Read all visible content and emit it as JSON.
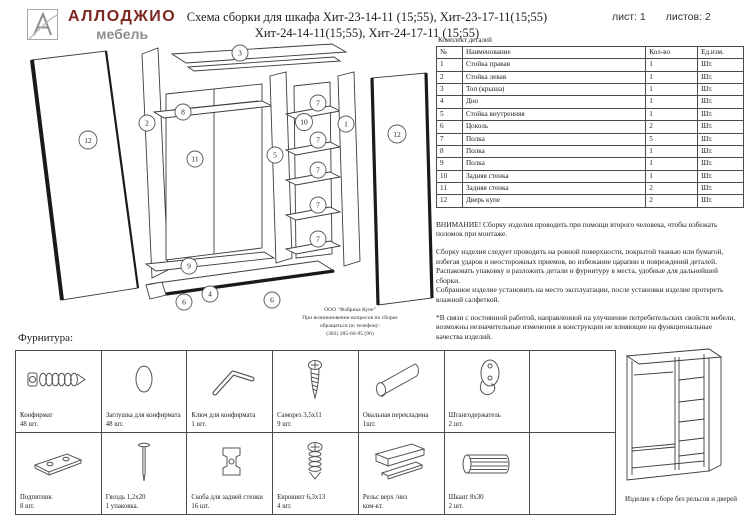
{
  "header": {
    "brand": "АЛЛОДЖИО",
    "brand_sub": "мебель",
    "brand_color": "#7d2723",
    "title_line1": "Схема сборки для шкафа Хит-23-14-11 (15;55), Хит-23-17-11(15;55)",
    "title_line2": "Хит-24-14-11(15;55), Хит-24-17-11 (15;55)",
    "sheet_label": "лист: 1",
    "sheets_label": "листов: 2"
  },
  "parts_table": {
    "caption": "Комплект деталей",
    "columns": [
      "№",
      "Наименование",
      "Кол-во",
      "Ед.изм."
    ],
    "rows": [
      {
        "n": "1",
        "name": "Стойка правая",
        "qty": "1",
        "unit": "Шт."
      },
      {
        "n": "2",
        "name": "Стойка левая",
        "qty": "1",
        "unit": "Шт."
      },
      {
        "n": "3",
        "name": "Топ (крыша)",
        "qty": "1",
        "unit": "Шт."
      },
      {
        "n": "4",
        "name": "Дно",
        "qty": "1",
        "unit": "Шт."
      },
      {
        "n": "5",
        "name": "Стойка внутренняя",
        "qty": "1",
        "unit": "Шт."
      },
      {
        "n": "6",
        "name": "Цоколь",
        "qty": "2",
        "unit": "Шт."
      },
      {
        "n": "7",
        "name": "Полка",
        "qty": "5",
        "unit": "Шт."
      },
      {
        "n": "8",
        "name": "Полка",
        "qty": "1",
        "unit": "Шт."
      },
      {
        "n": "9",
        "name": "Полка",
        "qty": "1",
        "unit": "Шт."
      },
      {
        "n": "10",
        "name": "Задняя стенка",
        "qty": "1",
        "unit": "Шт."
      },
      {
        "n": "11",
        "name": "Задняя стенка",
        "qty": "2",
        "unit": "Шт."
      },
      {
        "n": "12",
        "name": "Дверь купе",
        "qty": "2",
        "unit": "Шт."
      }
    ]
  },
  "notes": {
    "warning": "ВНИМАНИЕ! Сборку изделия проводить при помощи второго человека, чтобы избежать поломок при монтаже.",
    "p1": "Сборку изделия следует проводить на ровной поверхности, покрытой тканью или бумагой, избегая ударов и неосторожных приемов, во избежание царапин и повреждений деталей.",
    "p2": "Распаковать упаковку и разложить детали и фурнитуру в места, удобные для дальнейшей сборки.",
    "p3": "Собранное изделие установить на место эксплуатации, после установки изделие протереть влажной салфеткой.",
    "p4": "*В связи с постоянной работой, направленной на улучшение потребительских свойств мебели, возможны незначительные изменения в конструкции не влияющие на функциональные качества изделий."
  },
  "factory_note": {
    "line1": "ООО \"Фабрика Купе\"",
    "line2": "При возникновении вопросов по сборке",
    "line3": "обращаться по телефону:",
    "line4": "(383) 285-60-95 (96)"
  },
  "diagram": {
    "callouts": [
      "3",
      "12",
      "2",
      "8",
      "11",
      "5",
      "10",
      "7",
      "7",
      "7",
      "7",
      "7",
      "1",
      "12",
      "9",
      "4",
      "6",
      "6"
    ]
  },
  "hardware": {
    "heading": "Фурнитура:",
    "items": [
      {
        "name": "Конфирмат",
        "qty": "48 шт.",
        "icon": "confirmat-screw-icon"
      },
      {
        "name": "Заглушка для конфирмата",
        "qty": "48 шт.",
        "icon": "cap-icon"
      },
      {
        "name": "Ключ для конфирмата",
        "qty": "1 шт.",
        "icon": "hex-key-icon"
      },
      {
        "name": "Саморез 3,5х11",
        "qty": "9 шт.",
        "icon": "screw-icon"
      },
      {
        "name": "Овальная перекладина",
        "qty": "1шт.",
        "icon": "oval-rail-icon"
      },
      {
        "name": "Штангодержатель",
        "qty": "2 шт.",
        "icon": "rod-holder-icon"
      },
      {
        "name": "Подпятник",
        "qty": "8 шт.",
        "icon": "foot-pad-icon"
      },
      {
        "name": "Гвоздь 1,2х20",
        "qty": "1 упаковка.",
        "icon": "nail-icon"
      },
      {
        "name": "Скоба для задней стенки",
        "qty": "16 шт.",
        "icon": "back-wall-bracket-icon"
      },
      {
        "name": "Евровинт 6,3х13",
        "qty": "4 шт.",
        "icon": "euro-screw-icon"
      },
      {
        "name": "Рельс верх /низ",
        "qty": "ком-кт.",
        "icon": "rail-icon"
      },
      {
        "name": "Шкант 8х30",
        "qty": "2 шт.",
        "icon": "dowel-icon"
      }
    ]
  },
  "assembled": {
    "caption": "Изделие в сборе без рельсов и дверей"
  }
}
